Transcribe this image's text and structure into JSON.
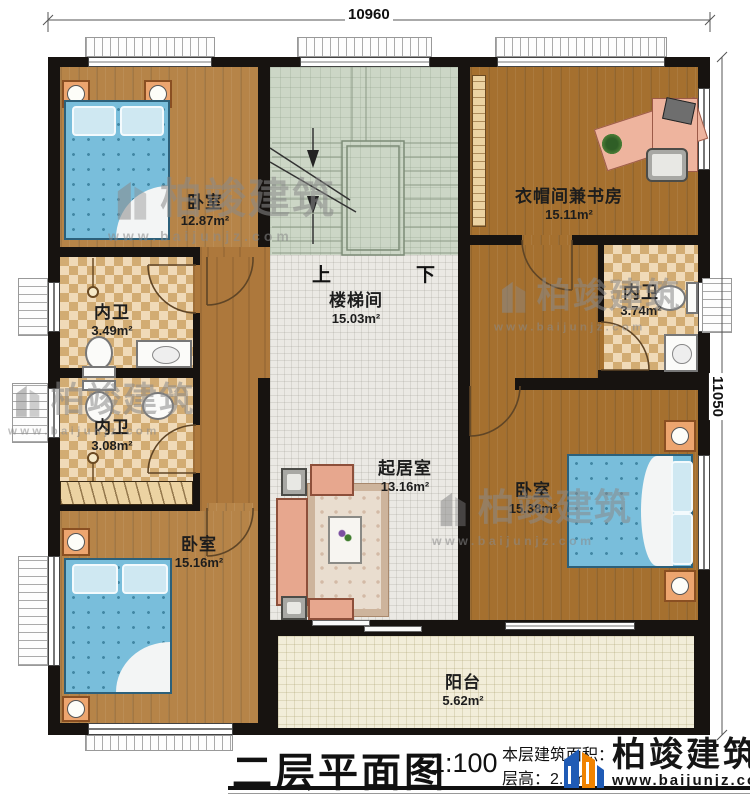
{
  "dimensions": {
    "top": "10960",
    "right": "11050"
  },
  "stair": {
    "up": "上",
    "down": "下"
  },
  "rooms": {
    "bedroom_tl": {
      "name": "卧室",
      "area": "12.87m²"
    },
    "stairwell": {
      "name": "楼梯间",
      "area": "15.03m²"
    },
    "study": {
      "name": "衣帽间兼书房",
      "area": "15.11m²"
    },
    "bath_left_1": {
      "name": "内卫",
      "area": "3.49m²"
    },
    "bath_left_2": {
      "name": "内卫",
      "area": "3.08m²"
    },
    "bath_right": {
      "name": "内卫",
      "area": "3.74m²"
    },
    "living": {
      "name": "起居室",
      "area": "13.16m²"
    },
    "bedroom_r": {
      "name": "卧室",
      "area": "15.38m²"
    },
    "bedroom_bl": {
      "name": "卧室",
      "area": "15.16m²"
    },
    "balcony": {
      "name": "阳台",
      "area": "5.62m²"
    }
  },
  "title_block": {
    "title": "二层平面图",
    "scale": "1:100",
    "info_line1": "本层建筑面积：",
    "info_line2": "层高：2.9m"
  },
  "brand": {
    "name": "柏竣建筑",
    "url": "www.baijunjz.com"
  },
  "colors": {
    "wall": "#171310",
    "wood": "#ab7a3e",
    "tile": "#e6c48c",
    "stair": "#ccd6c6",
    "bed": "#79bedb",
    "logo_blue": "#1f5bb5",
    "logo_orange": "#f08300"
  }
}
